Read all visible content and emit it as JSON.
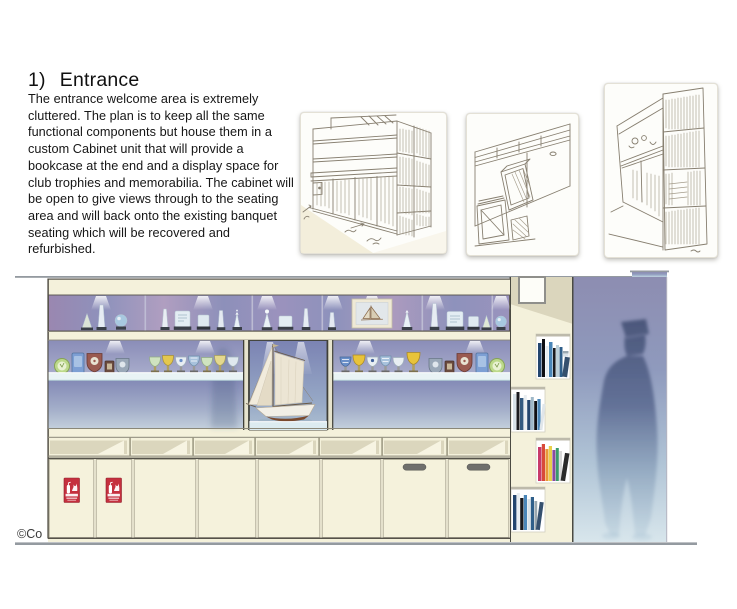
{
  "page": {
    "heading_number": "1)",
    "heading_text": "Entrance",
    "body_text": "The entrance welcome area is extremely cluttered. The plan is to keep all the same functional components but house them in a custom Cabinet unit that will provide a bookcase at the end and a display space for club trophies and memorabilia. The cabinet will be open to give views through to the seating area and will back onto the existing banquet seating which will be recovered and refurbished.",
    "copyright_text": "©Co"
  },
  "sketches": {
    "count": 3,
    "descriptions": [
      "pencil sketch of long cabinet with shelves and end bookcase",
      "pencil sketch of tilt-out bin detail",
      "pencil sketch perspective of bookcase end"
    ]
  },
  "elevation": {
    "cupboard_door_count": 8,
    "fire_extinguisher_sign_count": 2,
    "door_handle_count": 2,
    "pigeonhole_count": 7,
    "book_niche_count": 4,
    "display_top_row": "glass and crystal awards with framed sailing picture",
    "display_middle_left": "medals, shields, plaques and trophy cups",
    "display_middle_center": "model sailboat under downlights",
    "display_middle_right": "trophy cups, shields and plaques",
    "end_panel": "staggered book niches",
    "scale_figure": "human silhouette"
  },
  "colors": {
    "cabinet_cream": "#f4f1db",
    "cabinet_cream_light": "#f7f4e2",
    "shadow_beige": "#dbd6bd",
    "display_purple": "#9193bc",
    "open_view_top": "#848ab6",
    "open_view_bottom": "#c2cedb",
    "panel_top": "#8d8db1",
    "panel_bottom": "#d8e6ec",
    "fire_sign_red": "#c5303e",
    "outline_dark": "#55524a",
    "outline_mid": "#8a8778",
    "line_gray": "#949aa0",
    "sail_cream": "#ece5d4",
    "hull_brown": "#7a4a2e"
  }
}
